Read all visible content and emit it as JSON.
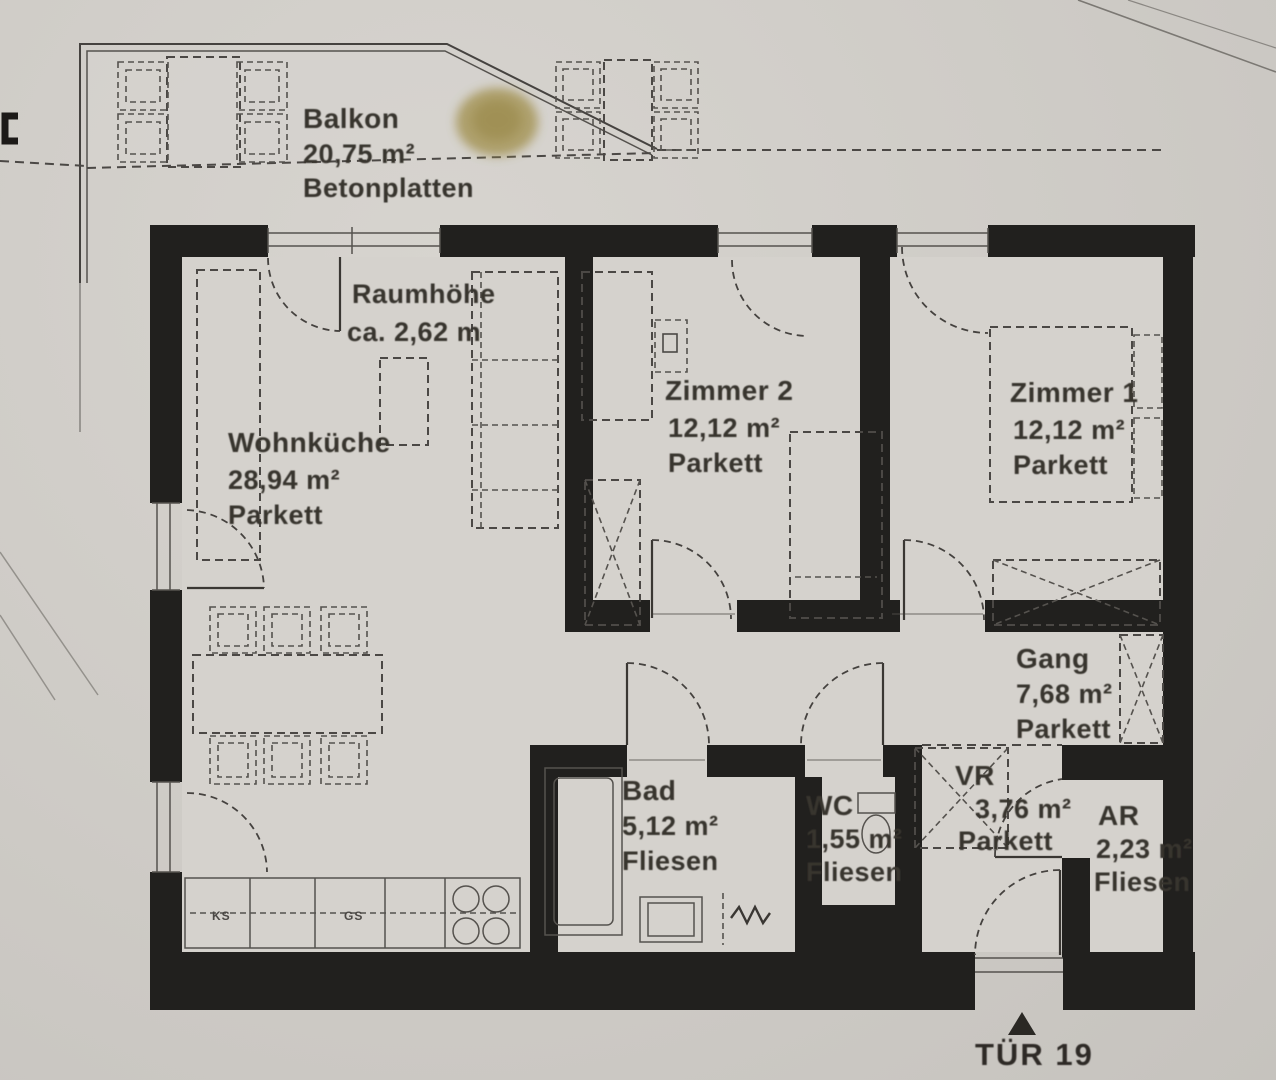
{
  "plan": {
    "balcony": {
      "name": "Balkon",
      "area": "20,75 m²",
      "floor": "Betonplatten"
    },
    "ceiling_note": {
      "line1": "Raumhöhe",
      "line2": "ca. 2,62 m"
    },
    "rooms": {
      "wohnkueche": {
        "name": "Wohnküche",
        "area": "28,94 m²",
        "floor": "Parkett"
      },
      "zimmer2": {
        "name": "Zimmer 2",
        "area": "12,12 m²",
        "floor": "Parkett"
      },
      "zimmer1": {
        "name": "Zimmer 1",
        "area": "12,12 m²",
        "floor": "Parkett"
      },
      "gang": {
        "name": "Gang",
        "area": "7,68 m²",
        "floor": "Parkett"
      },
      "bad": {
        "name": "Bad",
        "area": "5,12 m²",
        "floor": "Fliesen"
      },
      "wc": {
        "name": "WC",
        "area": "1,55 m²",
        "floor": "Fliesen"
      },
      "vr": {
        "name": "VR",
        "area": "3,76 m²",
        "floor": "Parkett"
      },
      "ar": {
        "name": "AR",
        "area": "2,23 m²",
        "floor": "Fliesen"
      }
    },
    "kitchen": {
      "ks": "KS",
      "gs": "GS"
    },
    "entrance": {
      "label": "TÜR 19"
    },
    "colors": {
      "paper": "#cecbc6",
      "wall": "#21201e",
      "stain": "#a29150"
    }
  }
}
